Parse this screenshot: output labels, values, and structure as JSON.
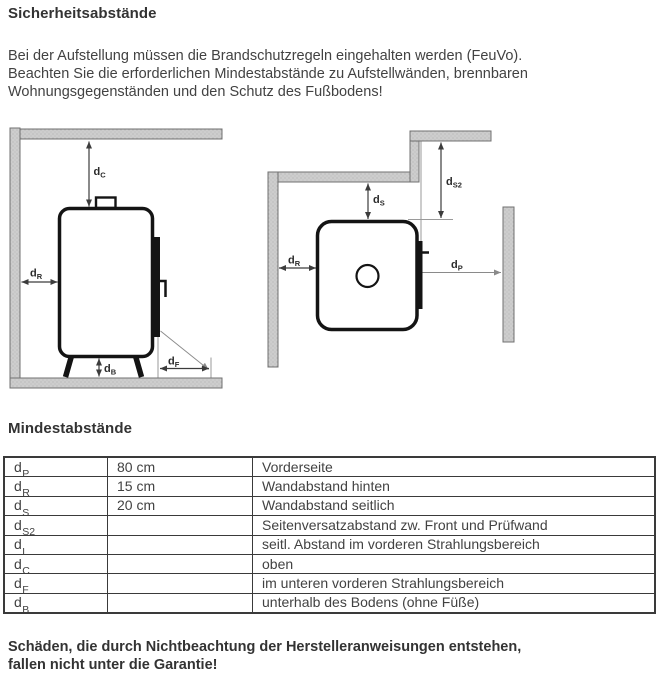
{
  "doc": {
    "title": "Sicherheitsabstände",
    "intro_lines": [
      "Bei der Aufstellung müssen die Brandschutzregeln eingehalten werden (FeuVo).",
      "Beachten Sie die erforderlichen Mindestabstände zu Aufstellwänden, brennbaren",
      "Wohnungsgegenständen und den Schutz des Fußbodens!"
    ],
    "section_title": "Mindestabstände",
    "warning_lines": [
      "Schäden, die durch Nichtbeachtung der Herstelleranweisungen entstehen,",
      "fallen nicht unter die Garantie!"
    ]
  },
  "diagram": {
    "labels": {
      "dc": {
        "main": "d",
        "sub": "C"
      },
      "dr": {
        "main": "d",
        "sub": "R"
      },
      "db": {
        "main": "d",
        "sub": "B"
      },
      "df": {
        "main": "d",
        "sub": "F"
      },
      "ds": {
        "main": "d",
        "sub": "S"
      },
      "ds2": {
        "main": "d",
        "sub": "S2"
      },
      "dp": {
        "main": "d",
        "sub": "P"
      }
    }
  },
  "table": {
    "rows": [
      {
        "sym_main": "d",
        "sym_sub": "P",
        "value": "80 cm",
        "desc": "Vorderseite"
      },
      {
        "sym_main": "d",
        "sym_sub": "R",
        "value": "15 cm",
        "desc": "Wandabstand hinten"
      },
      {
        "sym_main": "d",
        "sym_sub": "S",
        "value": "20 cm",
        "desc": "Wandabstand seitlich"
      },
      {
        "sym_main": "d",
        "sym_sub": "S2",
        "value": "",
        "desc": "Seitenversatzabstand zw. Front und Prüfwand"
      },
      {
        "sym_main": "d",
        "sym_sub": "L",
        "value": "",
        "desc": "seitl. Abstand im vorderen Strahlungsbereich"
      },
      {
        "sym_main": "d",
        "sym_sub": "C",
        "value": "",
        "desc": "oben"
      },
      {
        "sym_main": "d",
        "sym_sub": "F",
        "value": "",
        "desc": "im unteren vorderen Strahlungsbereich"
      },
      {
        "sym_main": "d",
        "sym_sub": "B",
        "value": "",
        "desc": "unterhalb des Bodens (ohne Füße)"
      }
    ]
  },
  "colors": {
    "text": "#3f3f3f",
    "wall_fill": "#cdcdcd",
    "wall_stroke": "#707070",
    "outline": "#141414",
    "arrow": "#3c3c3c",
    "construction_line": "#9a9a9a",
    "table_border": "#3a3a3a"
  }
}
